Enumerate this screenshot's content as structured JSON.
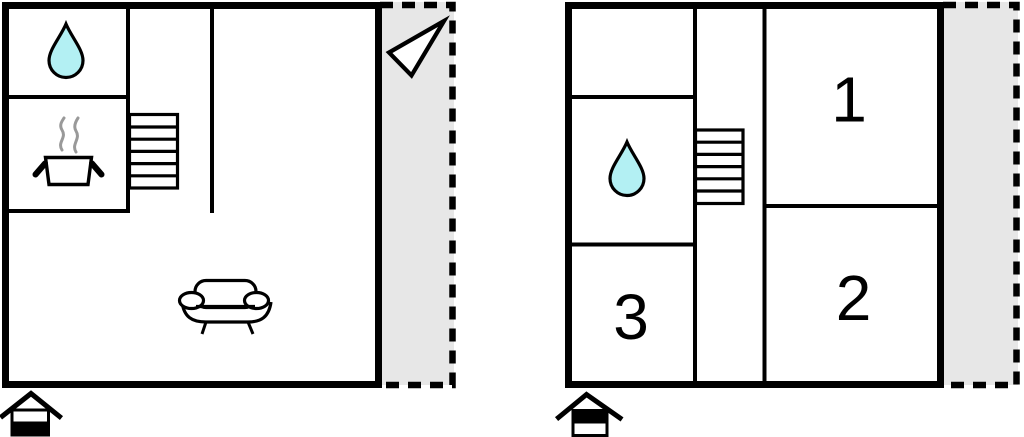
{
  "colors": {
    "wall": "#000000",
    "terrace_fill": "#e7e7e7",
    "water_drop_fill": "#b3f0f3",
    "steam": "#999999",
    "room_fill": "#ffffff"
  },
  "ground_floor_plan": {
    "icons": {
      "bathroom": "water-drop",
      "kitchen": "cooking-pot-with-steam",
      "stairs": "staircase",
      "living_room": "sofa",
      "orientation": "north-arrow",
      "floor_indicator": "house-ground-floor"
    },
    "room_labels": []
  },
  "first_floor_plan": {
    "icons": {
      "bathroom": "water-drop",
      "stairs": "staircase",
      "floor_indicator": "house-first-floor"
    },
    "room_labels": [
      "1",
      "2",
      "3"
    ]
  }
}
